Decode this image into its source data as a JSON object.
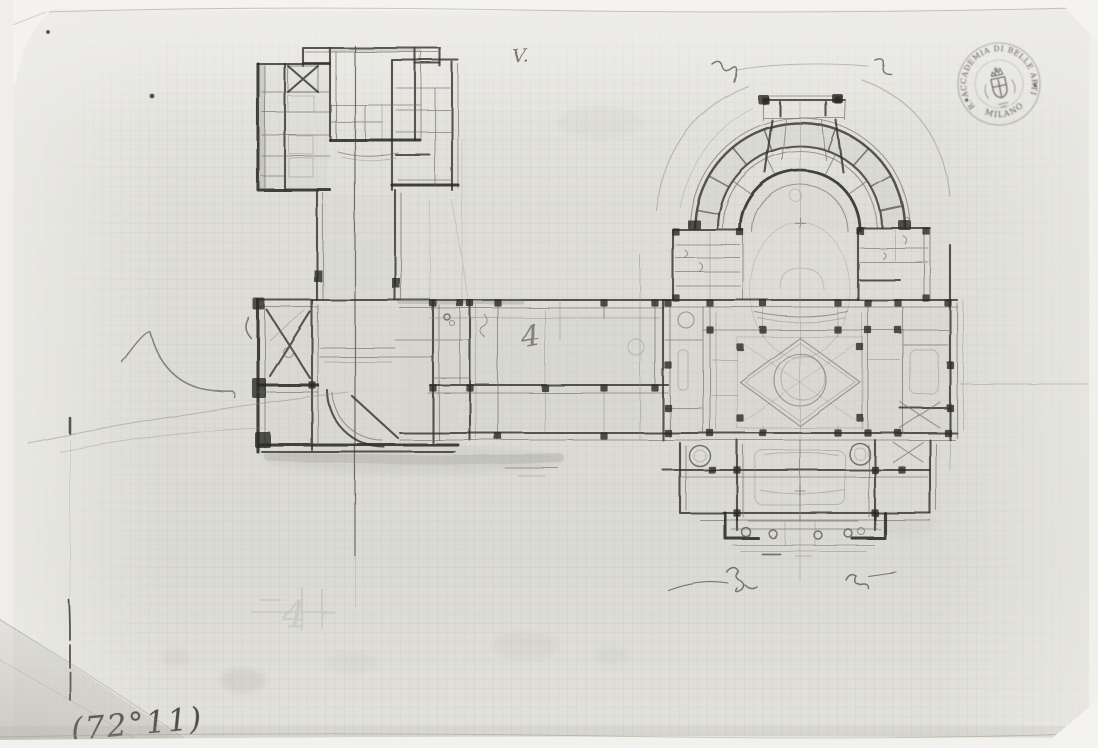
{
  "stamp": {
    "arc_text": "R. ACCADEMIA DI BELLE ARTI",
    "bottom_text": "MILANO"
  },
  "inscription": {
    "text": "(72°11)"
  },
  "annotations": {
    "v_mark": "V.",
    "numeral_4": "4",
    "ghost_numeral": "4"
  },
  "palette": {
    "paper": "#dedcd6",
    "grid_line": "#abb1a5",
    "pencil_dark": "#33312c",
    "pencil_mid": "#4a4842",
    "pencil_light": "#6d6b63",
    "stamp_ink": "#4c4a44",
    "scan_background": "#f6f5f2"
  }
}
